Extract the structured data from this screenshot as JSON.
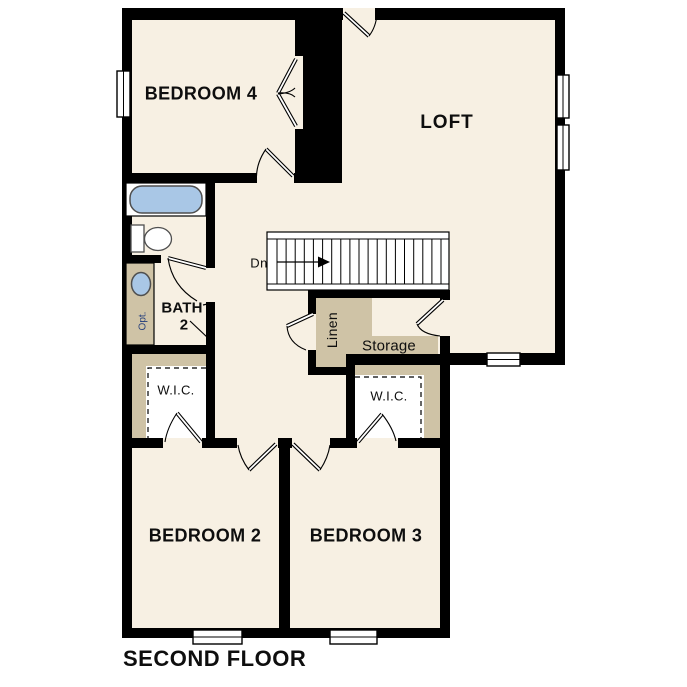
{
  "plan": {
    "title": "SECOND FLOOR",
    "labels": {
      "bedroom4": "BEDROOM 4",
      "loft": "LOFT",
      "bedroom2": "BEDROOM 2",
      "bedroom3": "BEDROOM 3",
      "bath_line1": "BATH",
      "bath_line2": "2",
      "wic1": "W.I.C.",
      "wic2": "W.I.C.",
      "linen": "Linen",
      "storage": "Storage",
      "stairs_direction": "Dn",
      "sink_option": "Opt."
    },
    "colors": {
      "floor": "#f7f0e3",
      "cabinet": "#cfc3a6",
      "wall": "#000000",
      "fixture_fill": "#a9c7e6",
      "fixture_stroke": "#4f4f4f",
      "window_fill": "#ffffff",
      "option_text": "#27407c",
      "label_text": "#0e0e0e"
    }
  }
}
